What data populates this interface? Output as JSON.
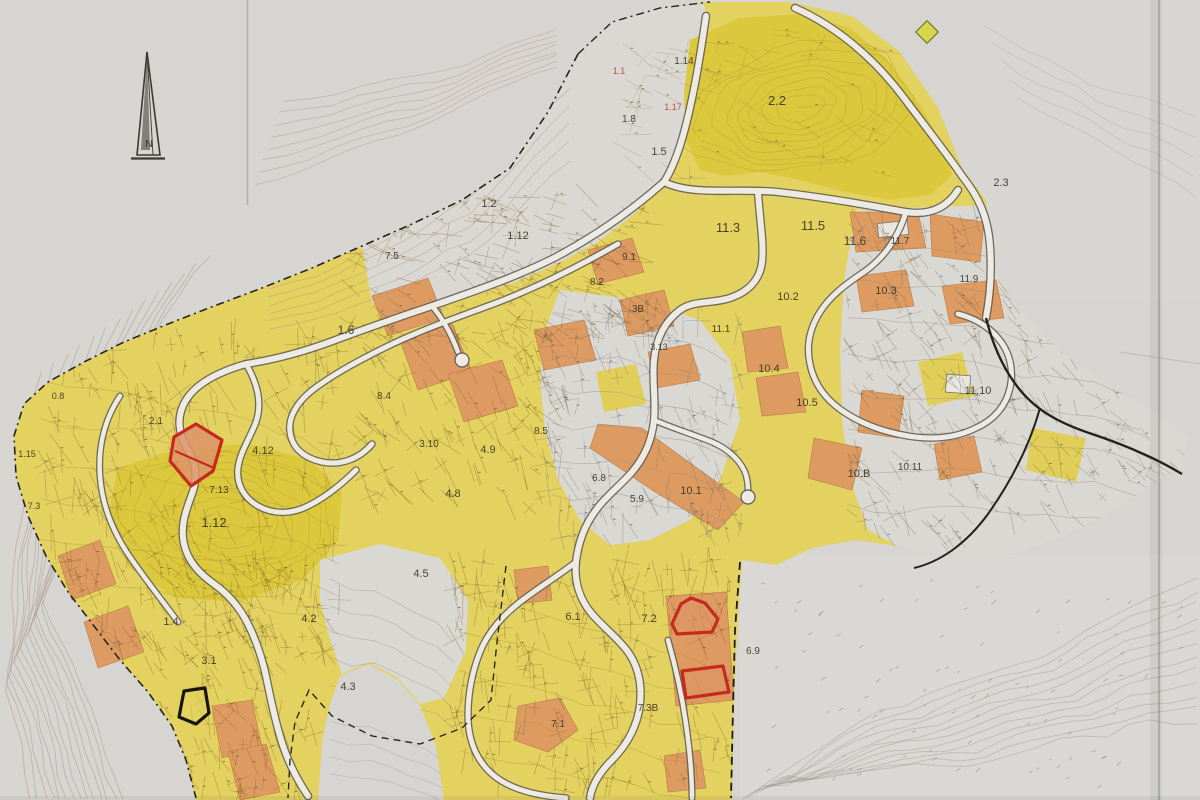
{
  "map": {
    "compass_label": "N",
    "palette": {
      "paper": "#d6d5d1",
      "parcel_yellow": "#e3d160",
      "parcel_deep_yellow": "#dcc83e",
      "parcel_orange": "#dd9b62",
      "road_fill": "#edeae4",
      "highlight_red": "#c52b1d",
      "highlight_black": "#16160f",
      "contour_pink": "#c0938a"
    },
    "labels": [
      {
        "t": "2.2",
        "x": 777,
        "y": 105,
        "s": 13
      },
      {
        "t": "2.3",
        "x": 1001,
        "y": 186,
        "s": 11
      },
      {
        "t": "1.14",
        "x": 684,
        "y": 64,
        "s": 10
      },
      {
        "t": "1.1",
        "x": 619,
        "y": 74,
        "s": 9,
        "c": "#b63a2c"
      },
      {
        "t": "1.17",
        "x": 673,
        "y": 110,
        "s": 9,
        "c": "#b63a2c"
      },
      {
        "t": "1.8",
        "x": 629,
        "y": 122,
        "s": 10
      },
      {
        "t": "1.5",
        "x": 659,
        "y": 155,
        "s": 11
      },
      {
        "t": "1.2",
        "x": 489,
        "y": 207,
        "s": 11
      },
      {
        "t": "1.12",
        "x": 518,
        "y": 239,
        "s": 11
      },
      {
        "t": "7.5",
        "x": 392,
        "y": 259,
        "s": 10
      },
      {
        "t": "11.3",
        "x": 728,
        "y": 232,
        "s": 13
      },
      {
        "t": "11.5",
        "x": 813,
        "y": 230,
        "s": 13
      },
      {
        "t": "11.6",
        "x": 855,
        "y": 245,
        "s": 12
      },
      {
        "t": "11.7",
        "x": 900,
        "y": 244,
        "s": 10
      },
      {
        "t": "10.2",
        "x": 788,
        "y": 300,
        "s": 11
      },
      {
        "t": "10.3",
        "x": 886,
        "y": 294,
        "s": 11
      },
      {
        "t": "11.9",
        "x": 969,
        "y": 282,
        "s": 10
      },
      {
        "t": "10.4",
        "x": 769,
        "y": 372,
        "s": 11
      },
      {
        "t": "10.5",
        "x": 807,
        "y": 406,
        "s": 11
      },
      {
        "t": "11.10",
        "x": 978,
        "y": 394,
        "s": 11
      },
      {
        "t": "10.B",
        "x": 859,
        "y": 477,
        "s": 11
      },
      {
        "t": "10.11",
        "x": 910,
        "y": 470,
        "s": 10
      },
      {
        "t": "1.6",
        "x": 346,
        "y": 334,
        "s": 12
      },
      {
        "t": "9.1",
        "x": 629,
        "y": 260,
        "s": 10
      },
      {
        "t": "8.2",
        "x": 597,
        "y": 285,
        "s": 10
      },
      {
        "t": "3B",
        "x": 638,
        "y": 312,
        "s": 10
      },
      {
        "t": "3.13",
        "x": 659,
        "y": 350,
        "s": 9
      },
      {
        "t": "11.1",
        "x": 721,
        "y": 332,
        "s": 10
      },
      {
        "t": "8.4",
        "x": 384,
        "y": 399,
        "s": 10
      },
      {
        "t": "3.10",
        "x": 429,
        "y": 447,
        "s": 10
      },
      {
        "t": "4.12",
        "x": 263,
        "y": 454,
        "s": 11
      },
      {
        "t": "4.9",
        "x": 488,
        "y": 453,
        "s": 11
      },
      {
        "t": "4.8",
        "x": 453,
        "y": 497,
        "s": 11
      },
      {
        "t": "7.13",
        "x": 219,
        "y": 493,
        "s": 10
      },
      {
        "t": "2.1",
        "x": 156,
        "y": 424,
        "s": 10
      },
      {
        "t": "0.8",
        "x": 58,
        "y": 399,
        "s": 9
      },
      {
        "t": "1.15",
        "x": 27,
        "y": 457,
        "s": 9
      },
      {
        "t": "7.3",
        "x": 34,
        "y": 509,
        "s": 9
      },
      {
        "t": "1.12",
        "x": 214,
        "y": 527,
        "s": 13
      },
      {
        "t": "8.5",
        "x": 541,
        "y": 434,
        "s": 10
      },
      {
        "t": "6.8",
        "x": 599,
        "y": 481,
        "s": 10
      },
      {
        "t": "5.9",
        "x": 637,
        "y": 502,
        "s": 10
      },
      {
        "t": "10.1",
        "x": 691,
        "y": 494,
        "s": 11
      },
      {
        "t": "1.4",
        "x": 171,
        "y": 625,
        "s": 11
      },
      {
        "t": "3.1",
        "x": 209,
        "y": 664,
        "s": 11
      },
      {
        "t": "4.2",
        "x": 309,
        "y": 622,
        "s": 11
      },
      {
        "t": "4.5",
        "x": 421,
        "y": 577,
        "s": 11
      },
      {
        "t": "4.3",
        "x": 348,
        "y": 690,
        "s": 11
      },
      {
        "t": "6.1",
        "x": 573,
        "y": 620,
        "s": 11
      },
      {
        "t": "7.2",
        "x": 649,
        "y": 622,
        "s": 11
      },
      {
        "t": "6.9",
        "x": 753,
        "y": 654,
        "s": 10
      },
      {
        "t": "7.1",
        "x": 558,
        "y": 727,
        "s": 10
      },
      {
        "t": "7.3B",
        "x": 648,
        "y": 711,
        "s": 10
      }
    ],
    "highlights": [
      {
        "id": "highlighted-parcel-red-west",
        "color": "#c52b1d",
        "fill": "#dc9468",
        "fill_opacity": 0.85,
        "points": "174,437 196,424 222,440 213,471 191,486 170,461",
        "divider": "175,451 214,468"
      },
      {
        "id": "highlighted-parcel-red-south-upper",
        "color": "#c52b1d",
        "fill": "#dc9468",
        "fill_opacity": 0.6,
        "points": "672,624 681,604 691,598 705,603 718,619 712,632 677,634"
      },
      {
        "id": "highlighted-parcel-red-south-lower",
        "color": "#c52b1d",
        "fill": "#dc9468",
        "fill_opacity": 0.6,
        "points": "682,671 723,666 729,692 686,698"
      },
      {
        "id": "highlighted-parcel-black",
        "color": "#16160f",
        "fill": "#e4d25f",
        "fill_opacity": 0.5,
        "points": "184,691 205,688 209,713 196,724 179,717"
      }
    ]
  }
}
